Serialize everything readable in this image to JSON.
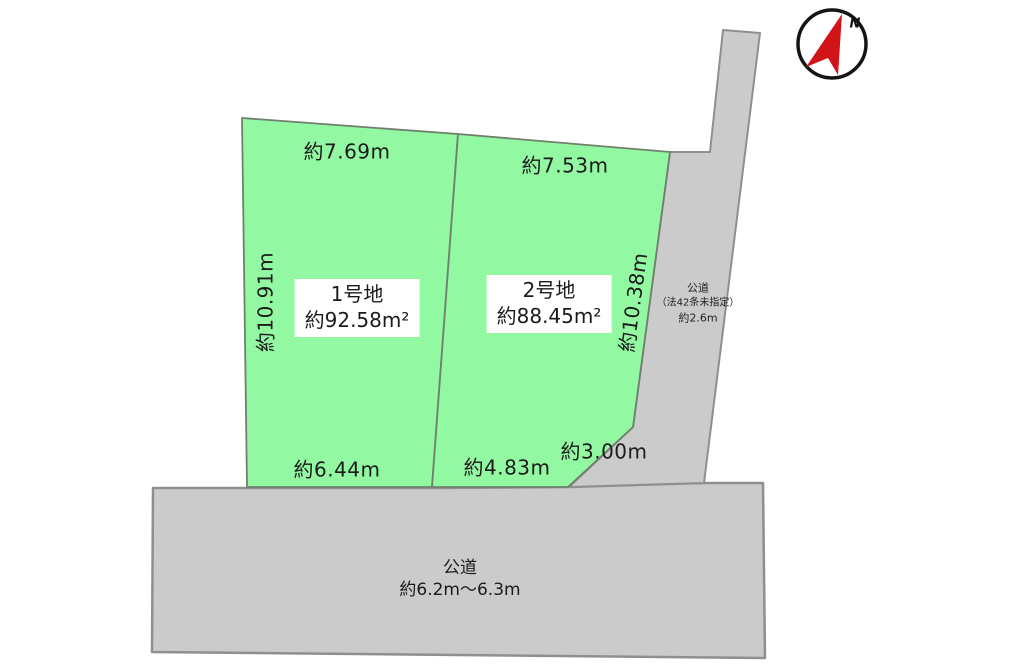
{
  "colors": {
    "plot_fill": "#93f8a2",
    "road_fill": "#cbcbcb",
    "plot_stroke": "#6f806f",
    "road_stroke": "#8f8f8f",
    "compass_red": "#d21418",
    "compass_ring": "#151515",
    "text": "#1b1b1b"
  },
  "plots": {
    "plot1": {
      "name": "1号地",
      "area": "約92.58m²",
      "top_length": "約7.69m",
      "left_length": "約10.91m",
      "bottom_length": "約6.44m"
    },
    "plot2": {
      "name": "2号地",
      "area": "約88.45m²",
      "top_length": "約7.53m",
      "right_length": "約10.38m",
      "bottom_length": "約4.83m",
      "corner_length": "約3.00m"
    }
  },
  "roads": {
    "right_road": {
      "line1": "公道",
      "line2": "（法42条未指定）",
      "line3": "約2.6m"
    },
    "bottom_road": {
      "name": "公道",
      "width": "約6.2m〜6.3m"
    }
  },
  "compass": {
    "label": "N"
  }
}
